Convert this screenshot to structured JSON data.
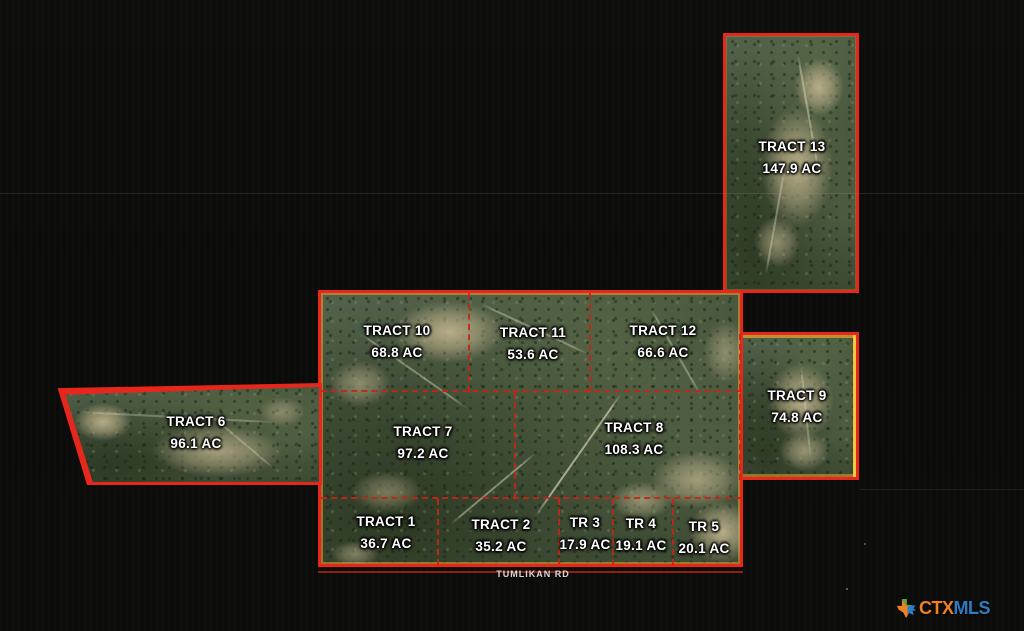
{
  "tracts": {
    "t1": {
      "name": "TRACT 1",
      "acres": "36.7 AC"
    },
    "t2": {
      "name": "TRACT 2",
      "acres": "35.2 AC"
    },
    "t3": {
      "name": "TR 3",
      "acres": "17.9 AC"
    },
    "t4": {
      "name": "TR 4",
      "acres": "19.1 AC"
    },
    "t5": {
      "name": "TR 5",
      "acres": "20.1 AC"
    },
    "t6": {
      "name": "TRACT 6",
      "acres": "96.1 AC"
    },
    "t7": {
      "name": "TRACT 7",
      "acres": "97.2 AC"
    },
    "t8": {
      "name": "TRACT 8",
      "acres": "108.3 AC"
    },
    "t9": {
      "name": "TRACT 9",
      "acres": "74.8 AC"
    },
    "t10": {
      "name": "TRACT 10",
      "acres": "68.8 AC"
    },
    "t11": {
      "name": "TRACT 11",
      "acres": "53.6 AC"
    },
    "t12": {
      "name": "TRACT 12",
      "acres": "66.6 AC"
    },
    "t13": {
      "name": "TRACT 13",
      "acres": "147.9 AC"
    }
  },
  "road": {
    "label": "TUMLIKAN RD"
  },
  "watermark": {
    "ctx": "CTX",
    "mls": "MLS"
  },
  "colors": {
    "boundary_red": "#e8271c",
    "boundary_inner_orange": "#f2a43c",
    "divider_dashed_red": "#c52614",
    "highlight_yellow": "#f2c93c",
    "logo_orange": "#ef8122",
    "logo_blue": "#2f7cc0",
    "background": "#0b0b09"
  }
}
